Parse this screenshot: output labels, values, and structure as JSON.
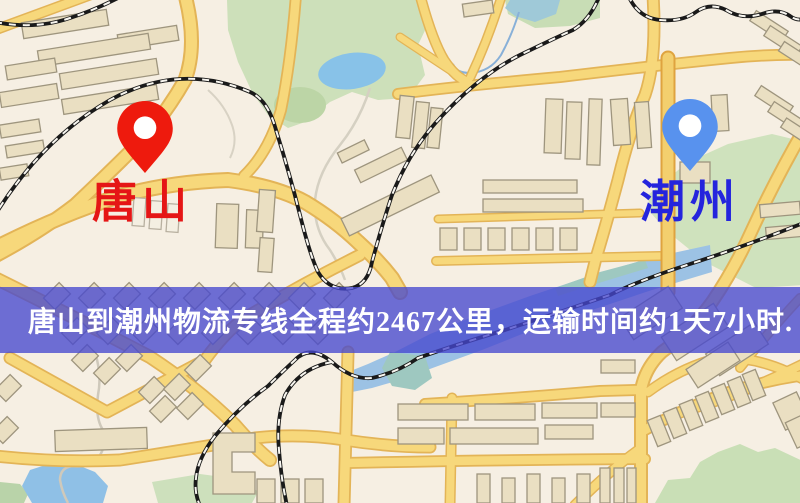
{
  "map": {
    "origin": {
      "label": "唐山",
      "pin_color": "#ee1a0d",
      "label_color": "#e51616"
    },
    "destination": {
      "label": "潮州",
      "pin_color": "#5892ee",
      "label_color": "#2424dd"
    },
    "banner": {
      "text": "唐山到潮州物流专线全程约2467公里，运输时间约1天7小时.",
      "bg_rgba": "rgba(70,72,206,0.78)",
      "text_color": "#ffffff"
    },
    "route": {
      "distance_km": "2467",
      "duration": "1天7小时"
    },
    "palette": {
      "land": "#f6efe3",
      "park": "#cde0ba",
      "water": "#9cc2e4",
      "road": "#f7d87b",
      "road_casing": "#e3b457",
      "railway": "#1a1a1a",
      "building": "#eadfc2"
    }
  }
}
